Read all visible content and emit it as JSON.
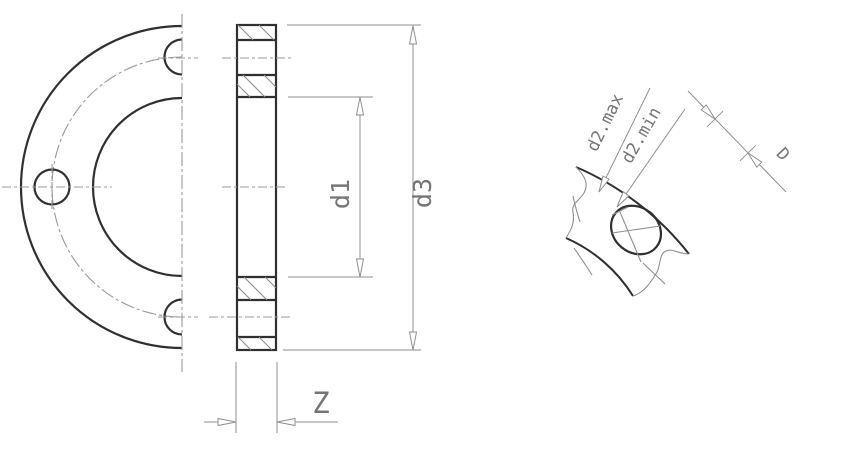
{
  "colors": {
    "background": "#ffffff",
    "outline": "#2f2f2f",
    "thin_line": "#8f8f8f",
    "centerline": "#999999",
    "label_text": "#757575"
  },
  "section_view": {
    "dim_d1": "d1",
    "dim_d3": "d3",
    "dim_z": "Z"
  },
  "detail_view": {
    "dim_d2max": "d2.max",
    "dim_d2min": "d2.min",
    "dim_d": "D"
  }
}
